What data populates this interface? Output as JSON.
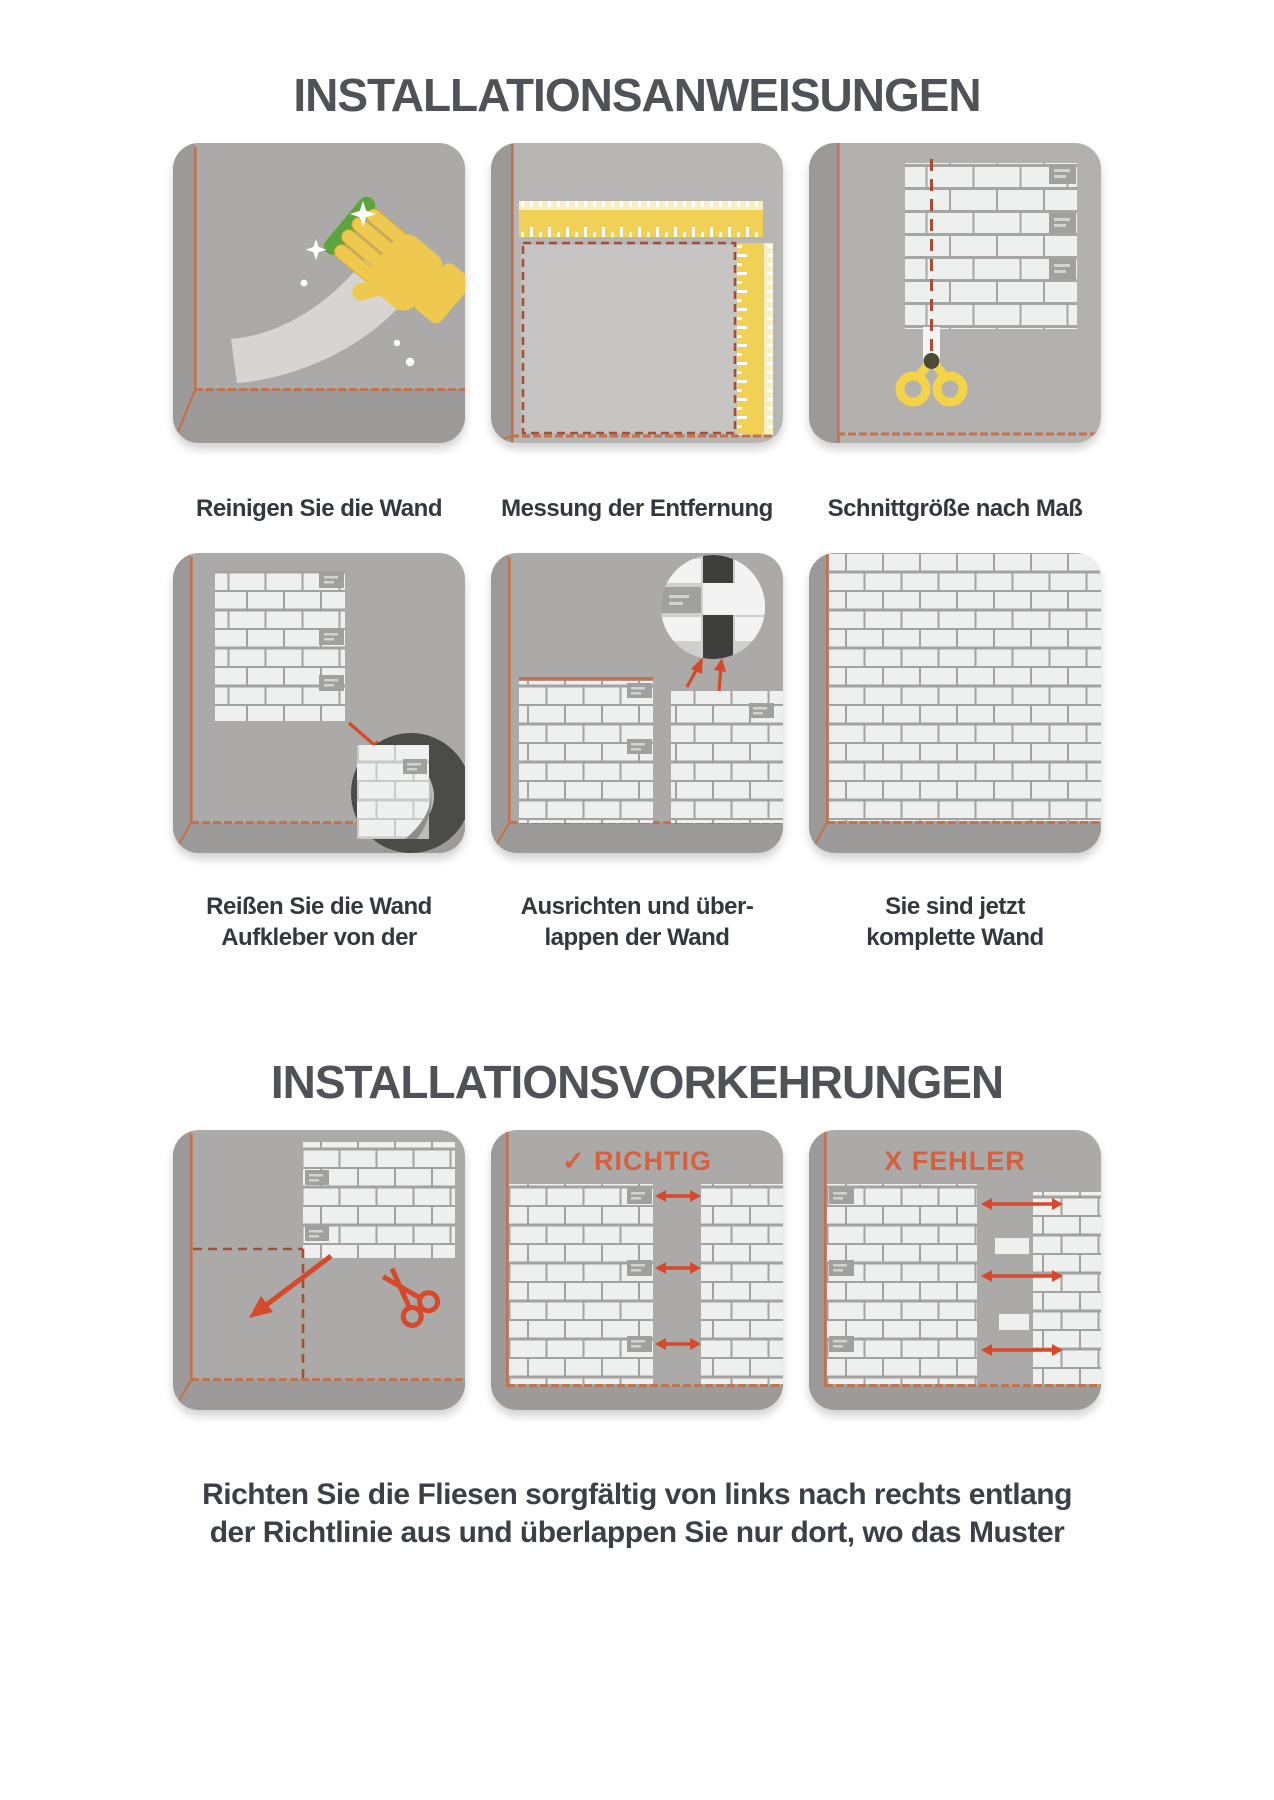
{
  "colors": {
    "panel_bg": "#abaaa8",
    "side_band": "#9b9a98",
    "floor": "#9c9b99",
    "wall_light": "#c6c5c3",
    "corner_line": "#c4704a",
    "dash_line": "#a64e33",
    "tile": "#eef0ef",
    "accent_tile": "#a0a09e",
    "accent_stripe": "#d2d3d1",
    "ruler_yellow": "#f0d055",
    "ruler_cream": "#f8efc6",
    "scissors_yellow": "#f3d347",
    "glove_yellow": "#efc94f",
    "sponge_green": "#5ea43e",
    "arrow_red": "#d6492a",
    "label_red": "#d8603e",
    "title_color": "#515257",
    "caption_color": "#34383e",
    "inset_dark": "#4b4b47"
  },
  "section1": {
    "title": "INSTALLATIONSANWEISUNGEN",
    "steps": [
      {
        "caption": "Reinigen Sie die Wand",
        "illustration": "clean-wall"
      },
      {
        "caption": "Messung der Entfernung",
        "illustration": "measure-distance"
      },
      {
        "caption": "Schnittgröße nach Maß",
        "illustration": "cut-to-size"
      },
      {
        "caption_lines": [
          "Reißen Sie die Wand",
          "Aufkleber von der"
        ],
        "illustration": "peel-backing"
      },
      {
        "caption_lines": [
          "Ausrichten und über-",
          "lappen der Wand"
        ],
        "illustration": "align-overlap"
      },
      {
        "caption_lines": [
          "Sie sind jetzt",
          "komplette Wand"
        ],
        "illustration": "complete-wall"
      }
    ]
  },
  "section2": {
    "title": "INSTALLATIONSVORKEHRUNGEN",
    "panels": [
      {
        "label": "",
        "illustration": "cut-corner"
      },
      {
        "label": "✓ RICHTIG",
        "illustration": "correct-alignment"
      },
      {
        "label": "X FEHLER",
        "illustration": "wrong-alignment"
      }
    ],
    "footer_lines": [
      "Richten Sie die Fliesen sorgfältig von links nach rechts entlang",
      "der Richtlinie aus und überlappen Sie nur dort, wo das Muster"
    ]
  }
}
